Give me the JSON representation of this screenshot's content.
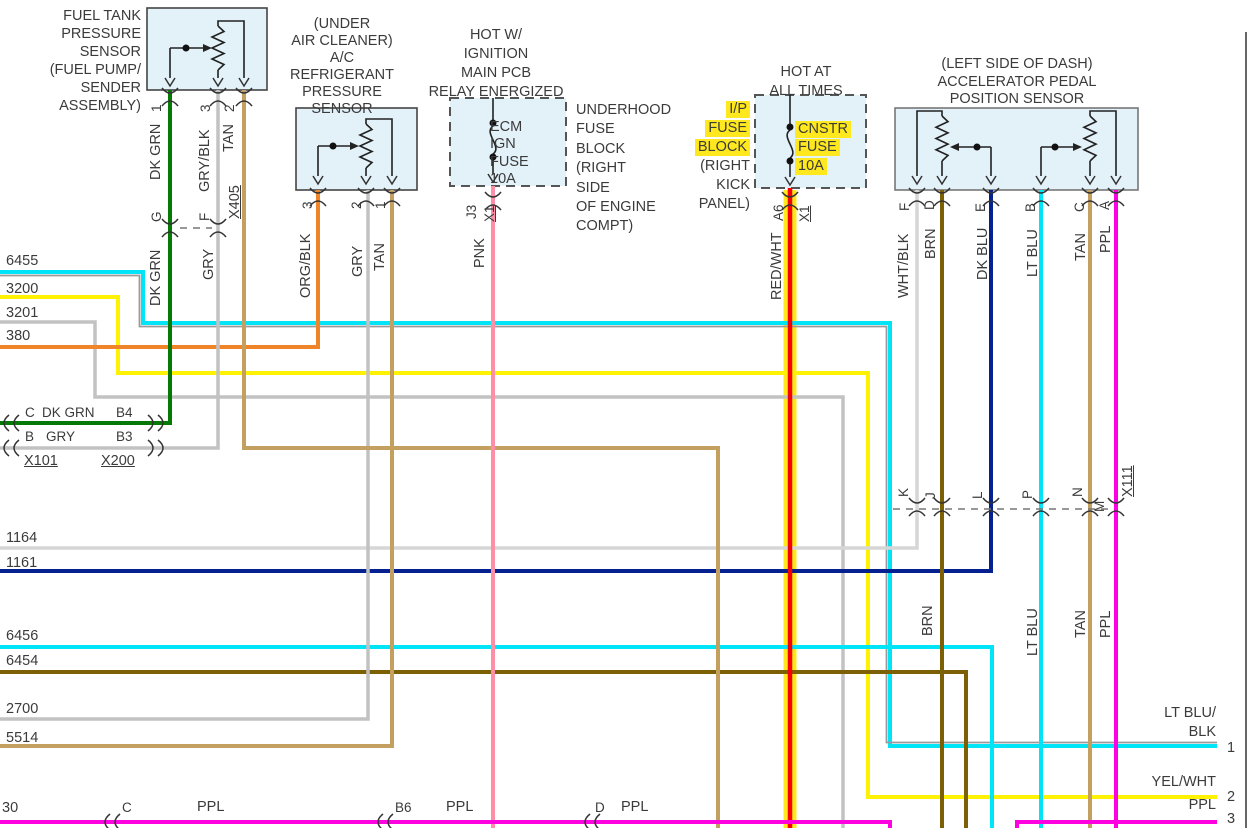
{
  "colors": {
    "dk_grn": "#047a04",
    "gry": "#c2c2c2",
    "gry_blk": "#c2c2c2",
    "tan": "#c3a060",
    "org_blk": "#f08428",
    "pnk": "#ff8fa6",
    "red_wht": "#f80000",
    "wht_blk": "#d6d6d6",
    "brn": "#7d5f04",
    "dk_blu": "#04218f",
    "lt_blu": "#00e4f8",
    "ppl": "#ff00e0",
    "yel": "#fff200",
    "highlight": "#ffe81e",
    "box_fill": "#e3f1f9"
  },
  "labels": [
    {
      "n": "fuel-sensor-title",
      "t": "FUEL TANK\nPRESSURE\nSENSOR\n(FUEL PUMP/\nSENDER ASSEMBLY)",
      "r": 141,
      "y": 7,
      "al": "r",
      "lh": 18
    },
    {
      "n": "ac-sensor-title",
      "t": "(UNDER\nAIR CLEANER)\nA/C REFRIGERANT\nPRESSURE\nSENSOR",
      "x": 276,
      "y": 16,
      "w": 132,
      "al": "c",
      "lh": 17
    },
    {
      "n": "ecm-hot-label",
      "t": "HOT W/\nIGNITION\nMAIN PCB\nRELAY ENERGIZED",
      "x": 426,
      "y": 26,
      "w": 140,
      "al": "c",
      "lh": 19
    },
    {
      "n": "hot-at-all-times-label",
      "t": "HOT AT\nALL TIMES",
      "x": 756,
      "y": 63,
      "w": 100,
      "al": "c",
      "lh": 19
    },
    {
      "n": "accel-sensor-title",
      "t": "(LEFT SIDE OF DASH)\nACCELERATOR PEDAL\nPOSITION SENSOR",
      "x": 937,
      "y": 56,
      "w": 160,
      "al": "c",
      "lh": 17.5
    },
    {
      "n": "underhood-fuse-block-label",
      "t": "UNDERHOOD\nFUSE\nBLOCK\n(RIGHT\nSIDE\nOF ENGINE\nCOMPT)",
      "x": 576,
      "y": 101,
      "lh": 19.4
    },
    {
      "n": "ip-fuse-block-line1",
      "t": "I/P",
      "r": 750,
      "y": 101,
      "hl": 1
    },
    {
      "n": "ip-fuse-block-line2",
      "t": "FUSE",
      "r": 750,
      "y": 120,
      "hl": 1
    },
    {
      "n": "ip-fuse-block-line3",
      "t": "BLOCK",
      "r": 750,
      "y": 139,
      "hl": 1
    },
    {
      "n": "ip-fuse-block-line4",
      "t": "(RIGHT",
      "r": 750,
      "y": 158
    },
    {
      "n": "ip-fuse-block-line5",
      "t": "KICK",
      "r": 750,
      "y": 177
    },
    {
      "n": "ip-fuse-block-line6",
      "t": "PANEL)",
      "r": 750,
      "y": 196
    },
    {
      "n": "ecm-fuse-label",
      "t": "ECM\nIGN\nFUSE\n10A",
      "x": 490,
      "y": 119,
      "lh": 17.3
    },
    {
      "n": "cnstr-fuse-line1",
      "t": "CNSTR",
      "x": 795,
      "y": 121,
      "hl": 1
    },
    {
      "n": "cnstr-fuse-line2",
      "t": "FUSE",
      "x": 795,
      "y": 139,
      "hl": 1
    },
    {
      "n": "cnstr-fuse-line3",
      "t": "10A",
      "x": 795,
      "y": 158,
      "hl": 1
    },
    {
      "n": "wire-6455-number",
      "t": "6455",
      "x": 6,
      "y": 253
    },
    {
      "n": "wire-3200-number",
      "t": "3200",
      "x": 6,
      "y": 281
    },
    {
      "n": "wire-3201-number",
      "t": "3201",
      "x": 6,
      "y": 305
    },
    {
      "n": "wire-380-number",
      "t": "380",
      "x": 6,
      "y": 328
    },
    {
      "n": "wire-1164-number",
      "t": "1164",
      "x": 6,
      "y": 530
    },
    {
      "n": "wire-1161-number",
      "t": "1161",
      "x": 6,
      "y": 555
    },
    {
      "n": "wire-6456-number",
      "t": "6456",
      "x": 6,
      "y": 628
    },
    {
      "n": "wire-6454-number",
      "t": "6454",
      "x": 6,
      "y": 653
    },
    {
      "n": "wire-2700-number",
      "t": "2700",
      "x": 6,
      "y": 701
    },
    {
      "n": "wire-5514-number",
      "t": "5514",
      "x": 6,
      "y": 730
    },
    {
      "n": "wire-30-number",
      "t": "30",
      "x": 2,
      "y": 800
    },
    {
      "n": "x101-pin-c",
      "t": "C",
      "x": 25,
      "y": 404,
      "fs": 13.5
    },
    {
      "n": "x101-dkgrn-label",
      "t": "DK GRN",
      "x": 42,
      "y": 404,
      "fs": 13.5
    },
    {
      "n": "x200-pin-b4",
      "t": "B4",
      "x": 116,
      "y": 404,
      "fs": 13.5
    },
    {
      "n": "x101-pin-b",
      "t": "B",
      "x": 25,
      "y": 428,
      "fs": 13.5
    },
    {
      "n": "x101-gry-label",
      "t": "GRY",
      "x": 46,
      "y": 428,
      "fs": 13.5
    },
    {
      "n": "x200-pin-b3",
      "t": "B3",
      "x": 116,
      "y": 428,
      "fs": 13.5
    },
    {
      "n": "connector-x101-label",
      "t": "X101",
      "x": 24,
      "y": 453,
      "u": 1
    },
    {
      "n": "connector-x200-label",
      "t": "X200",
      "x": 101,
      "y": 453,
      "u": 1
    },
    {
      "n": "wire-30-pin-c",
      "t": "C",
      "x": 122,
      "y": 799,
      "fs": 13.5
    },
    {
      "n": "wire-30-ppl-label1",
      "t": "PPL",
      "x": 197,
      "y": 799
    },
    {
      "n": "wire-30-pin-b6",
      "t": "B6",
      "x": 395,
      "y": 799,
      "fs": 13.5
    },
    {
      "n": "wire-30-ppl-label2",
      "t": "PPL",
      "x": 446,
      "y": 799
    },
    {
      "n": "wire-30-pin-d",
      "t": "D",
      "x": 595,
      "y": 799,
      "fs": 13.5
    },
    {
      "n": "wire-30-ppl-label3",
      "t": "PPL",
      "x": 621,
      "y": 799
    },
    {
      "n": "pin1-color-label",
      "t": "LT BLU/",
      "r": 1216,
      "y": 705
    },
    {
      "n": "pin1-color-label2",
      "t": "BLK",
      "r": 1216,
      "y": 724
    },
    {
      "n": "pin1-number",
      "t": "1",
      "x": 1227,
      "y": 740
    },
    {
      "n": "pin2-color-label",
      "t": "YEL/WHT",
      "r": 1216,
      "y": 774
    },
    {
      "n": "pin2-number",
      "t": "2",
      "x": 1227,
      "y": 789
    },
    {
      "n": "pin3-color-label",
      "t": "PPL",
      "r": 1216,
      "y": 797
    },
    {
      "n": "pin3-number",
      "t": "3",
      "x": 1227,
      "y": 811
    },
    {
      "n": "fuel-pin1-number",
      "t": "1",
      "x": 150,
      "y": 112,
      "rot": 1,
      "fs": 13.5
    },
    {
      "n": "fuel-pin1-color",
      "t": "DK GRN",
      "x": 149,
      "y": 180,
      "rot": 1
    },
    {
      "n": "fuel-pin3-number",
      "t": "3",
      "x": 199,
      "y": 112,
      "rot": 1,
      "fs": 13.5
    },
    {
      "n": "fuel-pin3-color",
      "t": "GRY/BLK",
      "x": 198,
      "y": 192,
      "rot": 1
    },
    {
      "n": "fuel-pin2-number",
      "t": "2",
      "x": 223,
      "y": 112,
      "rot": 1,
      "fs": 13.5
    },
    {
      "n": "fuel-pin2-color",
      "t": "TAN",
      "x": 222,
      "y": 152,
      "rot": 1
    },
    {
      "n": "connector-x405-label",
      "t": "X405",
      "x": 228,
      "y": 219,
      "rot": 1,
      "u": 1
    },
    {
      "n": "x405-pin-g",
      "t": "G",
      "x": 150,
      "y": 222,
      "rot": 1,
      "fs": 13.5
    },
    {
      "n": "x405-pin-f",
      "t": "F",
      "x": 198,
      "y": 221,
      "rot": 1,
      "fs": 13.5
    },
    {
      "n": "dkgrn-lower-label",
      "t": "DK GRN",
      "x": 149,
      "y": 306,
      "rot": 1
    },
    {
      "n": "gry-lower-label",
      "t": "GRY",
      "x": 202,
      "y": 280,
      "rot": 1
    },
    {
      "n": "ac-pin3-number",
      "t": "3",
      "x": 301,
      "y": 209,
      "rot": 1,
      "fs": 13.5
    },
    {
      "n": "ac-pin3-color",
      "t": "ORG/BLK",
      "x": 299,
      "y": 298,
      "rot": 1
    },
    {
      "n": "ac-pin2-number",
      "t": "2",
      "x": 350,
      "y": 209,
      "rot": 1,
      "fs": 13.5
    },
    {
      "n": "ac-pin2-color",
      "t": "GRY",
      "x": 351,
      "y": 277,
      "rot": 1
    },
    {
      "n": "ac-pin1-number",
      "t": "1",
      "x": 374,
      "y": 209,
      "rot": 1,
      "fs": 13.5
    },
    {
      "n": "ac-pin1-color",
      "t": "TAN",
      "x": 373,
      "y": 271,
      "rot": 1
    },
    {
      "n": "ecm-pin-j3",
      "t": "J3",
      "x": 465,
      "y": 219,
      "rot": 1,
      "fs": 13.5
    },
    {
      "n": "ecm-x1-label",
      "t": "X1",
      "x": 483,
      "y": 222,
      "rot": 1,
      "u": 1,
      "fs": 13.5
    },
    {
      "n": "pnk-color-label",
      "t": "PNK",
      "x": 473,
      "y": 268,
      "rot": 1
    },
    {
      "n": "cnstr-pin-a6",
      "t": "A6",
      "x": 772,
      "y": 221,
      "rot": 1,
      "fs": 13.5
    },
    {
      "n": "cnstr-x1-label",
      "t": "X1",
      "x": 798,
      "y": 222,
      "rot": 1,
      "u": 1,
      "fs": 13.5
    },
    {
      "n": "redwht-color-label",
      "t": "RED/WHT",
      "x": 770,
      "y": 300,
      "rot": 1
    },
    {
      "n": "accel-pin-f",
      "t": "F",
      "x": 898,
      "y": 211,
      "rot": 1,
      "fs": 13.5
    },
    {
      "n": "accel-pinf-color",
      "t": "WHT/BLK",
      "x": 897,
      "y": 298,
      "rot": 1
    },
    {
      "n": "accel-pin-d",
      "t": "D",
      "x": 923,
      "y": 210,
      "rot": 1,
      "fs": 13.5
    },
    {
      "n": "accel-pind-color",
      "t": "BRN",
      "x": 924,
      "y": 259,
      "rot": 1
    },
    {
      "n": "accel-pin-e",
      "t": "E",
      "x": 974,
      "y": 212,
      "rot": 1,
      "fs": 13.5
    },
    {
      "n": "accel-pine-color",
      "t": "DK BLU",
      "x": 976,
      "y": 280,
      "rot": 1
    },
    {
      "n": "accel-pin-b",
      "t": "B",
      "x": 1024,
      "y": 212,
      "rot": 1,
      "fs": 13.5
    },
    {
      "n": "accel-pinb-color",
      "t": "LT BLU",
      "x": 1026,
      "y": 277,
      "rot": 1
    },
    {
      "n": "accel-pin-c",
      "t": "C",
      "x": 1073,
      "y": 212,
      "rot": 1,
      "fs": 13.5
    },
    {
      "n": "accel-pinc-color",
      "t": "TAN",
      "x": 1074,
      "y": 261,
      "rot": 1
    },
    {
      "n": "accel-pin-a",
      "t": "A",
      "x": 1098,
      "y": 210,
      "rot": 1,
      "fs": 13.5
    },
    {
      "n": "accel-pina-color",
      "t": "PPL",
      "x": 1099,
      "y": 253,
      "rot": 1
    },
    {
      "n": "x111-pin-k",
      "t": "K",
      "x": 897,
      "y": 497,
      "rot": 1,
      "fs": 13.5
    },
    {
      "n": "x111-pin-j",
      "t": "J",
      "x": 924,
      "y": 499,
      "rot": 1,
      "fs": 13.5
    },
    {
      "n": "x111-pin-l",
      "t": "L",
      "x": 971,
      "y": 499,
      "rot": 1,
      "fs": 13.5
    },
    {
      "n": "x111-pin-p",
      "t": "P",
      "x": 1021,
      "y": 499,
      "rot": 1,
      "fs": 13.5
    },
    {
      "n": "x111-pin-n",
      "t": "N",
      "x": 1071,
      "y": 497,
      "rot": 1,
      "fs": 13.5
    },
    {
      "n": "x111-pin-m",
      "t": "M",
      "x": 1093,
      "y": 512,
      "rot": 1,
      "fs": 13.5
    },
    {
      "n": "connector-x111-label",
      "t": "X111",
      "x": 1121,
      "y": 497,
      "rot": 1,
      "u": 1
    },
    {
      "n": "brn-lower-label",
      "t": "BRN",
      "x": 921,
      "y": 636,
      "rot": 1
    },
    {
      "n": "ltblu-lower-label",
      "t": "LT BLU",
      "x": 1026,
      "y": 656,
      "rot": 1
    },
    {
      "n": "tan-lower-label",
      "t": "TAN",
      "x": 1074,
      "y": 638,
      "rot": 1
    },
    {
      "n": "ppl-lower-label",
      "t": "PPL",
      "x": 1099,
      "y": 638,
      "rot": 1
    }
  ]
}
